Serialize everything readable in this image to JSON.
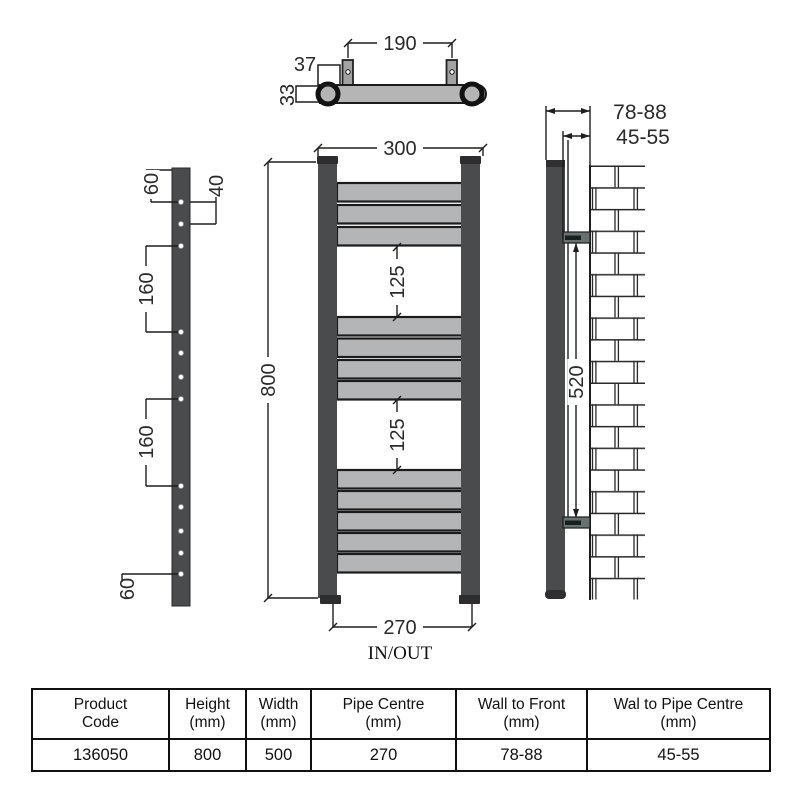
{
  "diagram": {
    "top_view": {
      "bracket_spacing": "190",
      "bracket_drop": "37",
      "tube_depth": "33"
    },
    "bracket_view": {
      "top_offset": "60",
      "hole_pair_gap": "40",
      "section_gap_1": "160",
      "section_gap_2": "160",
      "bottom_offset": "60"
    },
    "front_view": {
      "width": "300",
      "height": "800",
      "panel_gap_1": "125",
      "panel_gap_2": "125",
      "pipe_centre": "270",
      "inout_label": "IN/OUT"
    },
    "side_view": {
      "wall_to_front": "78-88",
      "wall_to_pipe_centre": "45-55",
      "bracket_span": "520"
    }
  },
  "table": {
    "columns": [
      {
        "line1": "Product",
        "line2": "Code",
        "value": "136050"
      },
      {
        "line1": "Height",
        "line2": "(mm)",
        "value": "800"
      },
      {
        "line1": "Width",
        "line2": "(mm)",
        "value": "500"
      },
      {
        "line1": "Pipe Centre",
        "line2": "(mm)",
        "value": "270"
      },
      {
        "line1": "Wall to Front",
        "line2": "(mm)",
        "value": "78-88"
      },
      {
        "line1": "Wal to Pipe Centre",
        "line2": "(mm)",
        "value": "45-55"
      }
    ]
  },
  "colors": {
    "tube_dark": "#4a4b4d",
    "rung_gray": "#b4b5b7",
    "line": "#1e1e1e"
  }
}
